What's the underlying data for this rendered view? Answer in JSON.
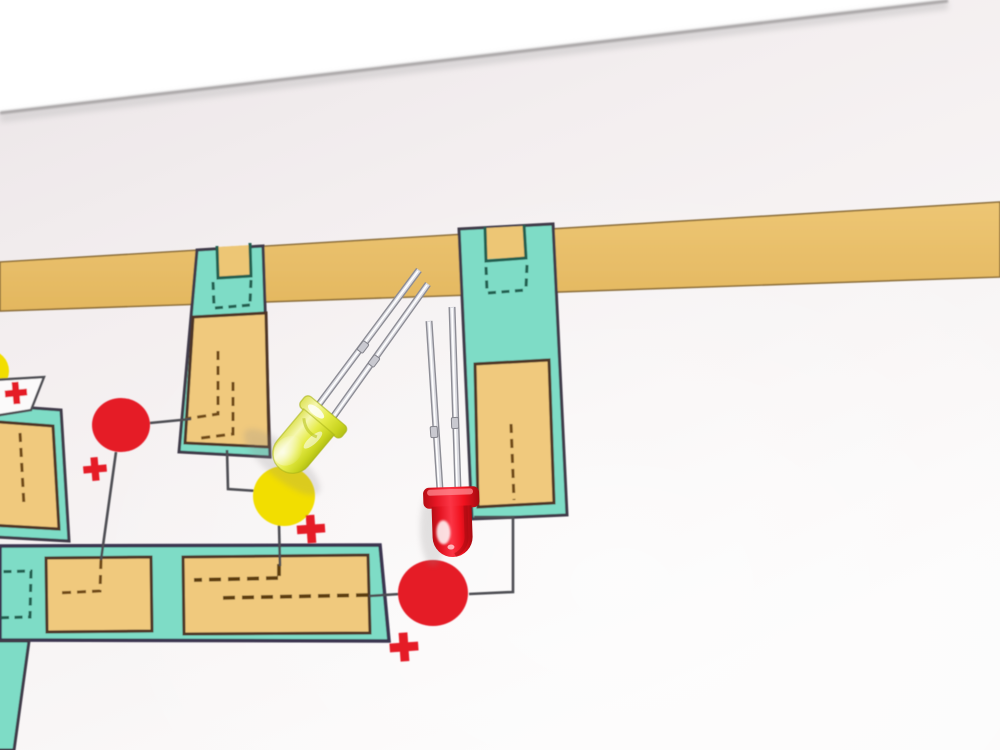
{
  "scene": {
    "description": "Close-up photo of a yellow LED and a red LED lying on a printed paper circuit template with copper-tape rail, terminal strips, solder pads, dashed hidden-wire marks, LED position circles and polarity plus signs",
    "visible_text": [],
    "objects": {
      "paper_sheet": "white template sheet photographed at an angle on a white surface",
      "gold_rail": "horizontal gold/copper tape band across the top of the printout",
      "terminal_strips": 2,
      "terminal_strip_note": "vertical teal strips with gold notch and dashed insertion square at top, tan pad below",
      "bottom_bus": "long horizontal teal bus bar with two tan pads and dashed wire marks",
      "side_component": "partially visible teal component with tan pad at left edge",
      "led_position_circles": {
        "red": 2,
        "yellow": 1,
        "yellow_partial_at_edge": 1
      },
      "polarity_plus_signs": 4,
      "real_leds": [
        {
          "color": "yellow",
          "state": "lying diagonally, leads pointing up-right, dome over yellow circle"
        },
        {
          "color": "red",
          "state": "vertical, dome pointing down, leads pointing up"
        }
      ],
      "wires": "thin dark printed connection lines linking circles, pads and bus"
    }
  },
  "palette": {
    "background": "#ffffff",
    "paper": "#f3eeef",
    "paper_edge_shadow": "#a5a2a3",
    "gold": "#edc674",
    "gold_deep": "#e3b75f",
    "teal": "#7edcc6",
    "teal_dark": "#215e50",
    "outline_dark": "#3f3a49",
    "tan": "#f0c97d",
    "brown_dark": "#4d3426",
    "brown_dash": "#6f4a14",
    "wire": "#4e4d52",
    "red_print": "#e51a28",
    "yellow_print": "#f2de00",
    "led_red": "#f1121f",
    "led_red_dark": "#b50d14",
    "led_yellow": "#e6ec49",
    "led_yellow_light": "#f6f7b0",
    "lead_silver": "#dcdce2",
    "lead_silver_dark": "#8d8d95"
  }
}
